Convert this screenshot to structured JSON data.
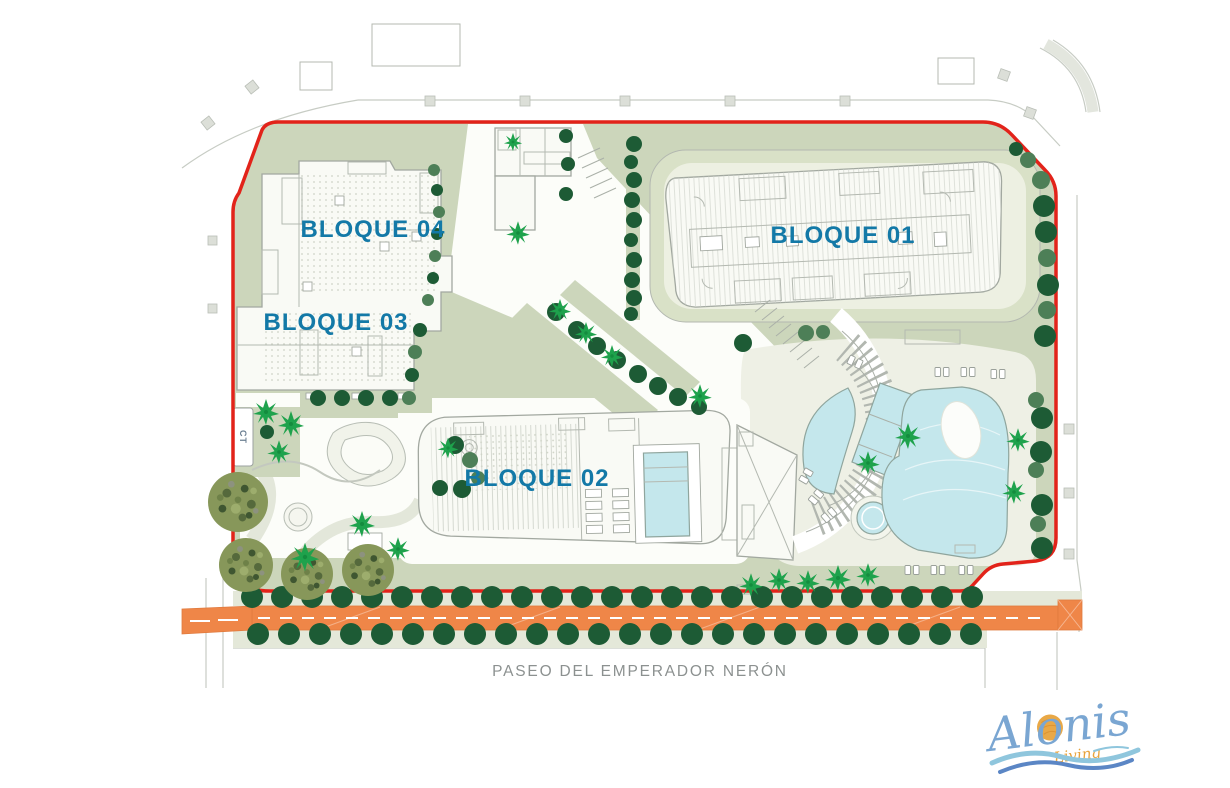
{
  "plan": {
    "labels": {
      "bloque01": "BLOQUE 01",
      "bloque02": "BLOQUE 02",
      "bloque03": "BLOQUE 03",
      "bloque04": "BLOQUE 04",
      "ct": "CT",
      "street": "PASEO DEL EMPERADOR NERÓN"
    },
    "logo": {
      "name": "Alonis",
      "tagline": "Living"
    },
    "theme": {
      "boundary_red": "#e2231a",
      "label_blue": "#1379a7",
      "sage_green": "#ccd6bb",
      "tree_dark": "#1d5b35",
      "tree_mid": "#4d7f57",
      "palm_green": "#1ea24c",
      "bush_olive": "#87975a",
      "pool_blue": "#c4e7ec",
      "street_orange": "#ef8648",
      "street_text_gray": "#8c9190",
      "logo_blue": "#7aa6d2",
      "logo_orange": "#e8a33c",
      "wave_light": "#8fc6dd",
      "wave_dark": "#5b86c5"
    },
    "decor": {
      "street_trees_top": {
        "y": 597,
        "x_start": 252,
        "step": 30,
        "count": 25,
        "r": 11
      },
      "street_trees_bottom": {
        "y": 634,
        "x_start": 258,
        "step": 31,
        "count": 24,
        "r": 11
      },
      "trees": [
        [
          1041,
          180,
          9,
          "m"
        ],
        [
          1044,
          206,
          11,
          "d"
        ],
        [
          1046,
          232,
          11,
          "d"
        ],
        [
          1047,
          258,
          9,
          "m"
        ],
        [
          1048,
          285,
          11,
          "d"
        ],
        [
          1047,
          310,
          9,
          "m"
        ],
        [
          1045,
          336,
          11,
          "d"
        ],
        [
          1036,
          400,
          8,
          "m"
        ],
        [
          1042,
          418,
          11,
          "d"
        ],
        [
          1041,
          452,
          11,
          "d"
        ],
        [
          1036,
          470,
          8,
          "m"
        ],
        [
          1042,
          505,
          11,
          "d"
        ],
        [
          1038,
          524,
          8,
          "m"
        ],
        [
          1042,
          548,
          11,
          "d"
        ],
        [
          1028,
          160,
          8,
          "m"
        ],
        [
          1016,
          149,
          7,
          "d"
        ],
        [
          634,
          144,
          8,
          "d"
        ],
        [
          631,
          162,
          7,
          "d"
        ],
        [
          634,
          180,
          8,
          "d"
        ],
        [
          632,
          200,
          8,
          "d"
        ],
        [
          634,
          220,
          8,
          "d"
        ],
        [
          631,
          240,
          7,
          "d"
        ],
        [
          634,
          260,
          8,
          "d"
        ],
        [
          632,
          280,
          8,
          "d"
        ],
        [
          634,
          298,
          8,
          "d"
        ],
        [
          631,
          314,
          7,
          "d"
        ],
        [
          434,
          170,
          6,
          "m"
        ],
        [
          437,
          190,
          6,
          "d"
        ],
        [
          439,
          212,
          6,
          "m"
        ],
        [
          437,
          234,
          6,
          "d"
        ],
        [
          435,
          256,
          6,
          "m"
        ],
        [
          433,
          278,
          6,
          "d"
        ],
        [
          428,
          300,
          6,
          "m"
        ],
        [
          420,
          330,
          7,
          "d"
        ],
        [
          415,
          352,
          7,
          "m"
        ],
        [
          412,
          375,
          7,
          "d"
        ],
        [
          409,
          398,
          7,
          "m"
        ],
        [
          556,
          312,
          9,
          "d"
        ],
        [
          577,
          330,
          9,
          "d"
        ],
        [
          597,
          346,
          9,
          "d"
        ],
        [
          617,
          360,
          9,
          "d"
        ],
        [
          638,
          374,
          9,
          "d"
        ],
        [
          658,
          386,
          9,
          "d"
        ],
        [
          678,
          397,
          9,
          "d"
        ],
        [
          699,
          407,
          8,
          "d"
        ],
        [
          318,
          398,
          8,
          "d"
        ],
        [
          342,
          398,
          8,
          "d"
        ],
        [
          366,
          398,
          8,
          "d"
        ],
        [
          390,
          398,
          8,
          "d"
        ],
        [
          267,
          432,
          7,
          "d"
        ],
        [
          455,
          445,
          9,
          "d"
        ],
        [
          470,
          460,
          8,
          "m"
        ],
        [
          440,
          488,
          8,
          "d"
        ],
        [
          462,
          489,
          9,
          "d"
        ],
        [
          478,
          478,
          7,
          "m"
        ],
        [
          566,
          136,
          7,
          "d"
        ],
        [
          568,
          164,
          7,
          "d"
        ],
        [
          566,
          194,
          7,
          "d"
        ],
        [
          743,
          343,
          9,
          "d"
        ],
        [
          806,
          333,
          8,
          "m"
        ],
        [
          823,
          332,
          7,
          "m"
        ]
      ],
      "palms": [
        [
          266,
          412,
          1
        ],
        [
          291,
          424,
          1
        ],
        [
          279,
          452,
          0.9
        ],
        [
          362,
          524,
          1
        ],
        [
          305,
          557,
          1.1
        ],
        [
          398,
          549,
          0.9
        ],
        [
          448,
          448,
          0.8
        ],
        [
          518,
          233,
          0.9
        ],
        [
          513,
          142,
          0.7
        ],
        [
          560,
          310,
          0.85
        ],
        [
          586,
          333,
          0.85
        ],
        [
          612,
          356,
          0.85
        ],
        [
          700,
          396,
          0.9
        ],
        [
          908,
          436,
          1
        ],
        [
          868,
          463,
          0.9
        ],
        [
          1018,
          440,
          0.9
        ],
        [
          1014,
          492,
          0.9
        ],
        [
          751,
          585,
          0.9
        ],
        [
          779,
          580,
          0.9
        ],
        [
          808,
          582,
          0.9
        ],
        [
          838,
          578,
          1
        ],
        [
          868,
          575,
          0.9
        ]
      ],
      "bushes": [
        [
          238,
          502,
          30
        ],
        [
          246,
          565,
          27
        ],
        [
          307,
          574,
          26
        ],
        [
          368,
          570,
          26
        ]
      ],
      "loungers": [
        [
          942,
          372,
          0
        ],
        [
          968,
          372,
          0
        ],
        [
          998,
          374,
          0
        ],
        [
          855,
          362,
          25
        ],
        [
          806,
          476,
          -60
        ],
        [
          816,
          497,
          -50
        ],
        [
          829,
          515,
          -40
        ],
        [
          912,
          570,
          0
        ],
        [
          938,
          570,
          0
        ],
        [
          966,
          570,
          0
        ]
      ]
    }
  }
}
